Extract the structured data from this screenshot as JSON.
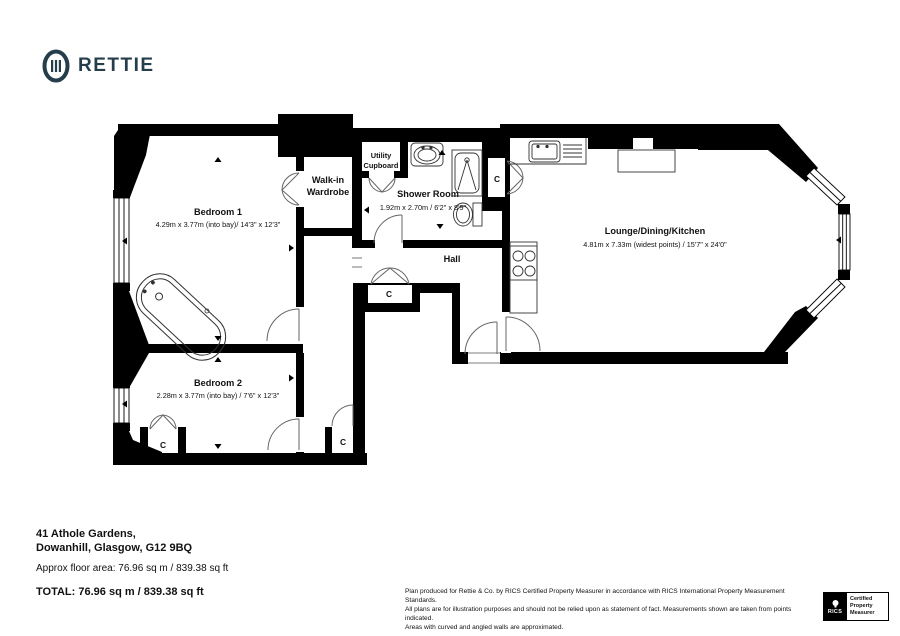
{
  "brand": {
    "name": "RETTIE",
    "color": "#263e4c"
  },
  "plan": {
    "rooms": {
      "bedroom1": {
        "name": "Bedroom 1",
        "dims": "4.29m x 3.77m (into bay)/ 14'3\" x 12'3\""
      },
      "bedroom2": {
        "name": "Bedroom 2",
        "dims": "2.28m x 3.77m (into bay) / 7'6\" x 12'3\""
      },
      "wardrobe": {
        "line1": "Walk-in",
        "line2": "Wardrobe"
      },
      "utility": {
        "line1": "Utility",
        "line2": "Cupboard"
      },
      "shower": {
        "name": "Shower Room",
        "dims": "1.92m x 2.70m / 6'2\" x 8'9\""
      },
      "hall": {
        "name": "Hall"
      },
      "lounge": {
        "name": "Lounge/Dining/Kitchen",
        "dims": "4.81m x 7.33m (widest points) / 15'7\" x 24'0\""
      }
    },
    "cupboard": "C"
  },
  "footer": {
    "address1": "41 Athole Gardens,",
    "address2": "Dowanhill, Glasgow, G12 9BQ",
    "area": "Approx floor area: 76.96 sq m / 839.38 sq ft",
    "total": "TOTAL: 76.96 sq m / 839.38 sq ft",
    "disclaimer1": "Plan produced for Rettie & Co. by RICS Certified Property Measurer in accordance with RICS International Property Measurement Standards.",
    "disclaimer2": "All plans are for illustration purposes and should not be relied upon as statement of fact.  Measurements shown are taken from points indicated.",
    "disclaimer3": "Areas with curved and angled walls are approximated.",
    "badge": {
      "org": "RICS",
      "line1": "Certified",
      "line2": "Property",
      "line3": "Measurer"
    }
  }
}
